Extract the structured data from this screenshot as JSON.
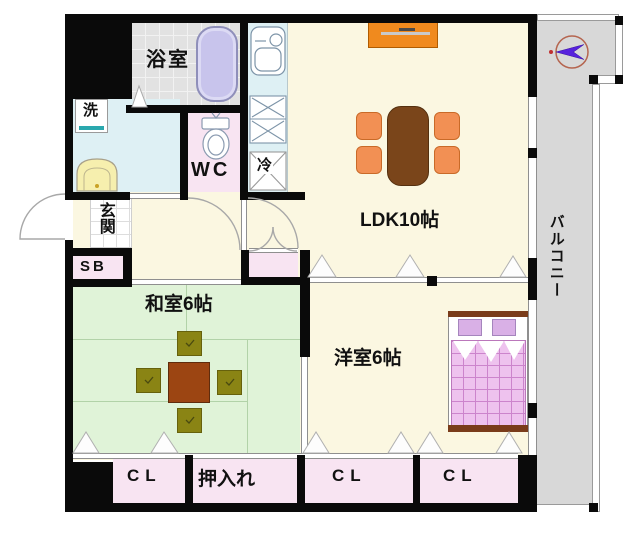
{
  "plan": {
    "rooms": {
      "bath": {
        "label": "浴室"
      },
      "washroom": {
        "washer_label": "洗"
      },
      "wc": {
        "label": "WC"
      },
      "kitchen": {
        "fridge_label": "冷"
      },
      "ldk": {
        "label": "LDK10帖"
      },
      "genkan": {
        "label": "玄関"
      },
      "shoe_box": {
        "label": "SB"
      },
      "washitsu": {
        "label": "和室6帖"
      },
      "yoshitsu": {
        "label": "洋室6帖"
      },
      "balcony": {
        "label": "バルコニー"
      },
      "closet_left": {
        "label": "CL"
      },
      "oshiire": {
        "label": "押入れ"
      },
      "closet_mid": {
        "label": "CL"
      },
      "closet_right": {
        "label": "CL"
      }
    },
    "icons": {
      "compass": "north-arrow-compass"
    },
    "colors": {
      "wall": "#0a0a0a",
      "ldk_floor": "#fbf7e1",
      "washitsu_floor": "#e0f3d8",
      "wet_area_floor": "#def0f4",
      "closet_floor": "#f8e4f2",
      "bath_floor": "#e2e2e2",
      "balcony_floor": "#d8d8d8",
      "bathtub": "#c8c4ec",
      "tv_board": "#f08a1e",
      "dining_table": "#7a451a",
      "chair": "#f29054",
      "low_table": "#9c4512",
      "zabuton": "#8a8414",
      "bed_blanket": "#eec2ee",
      "pillow": "#d9b0e6",
      "bed_frame": "#7a3c1a",
      "compass_arrow": "#5722dd",
      "compass_ring": "#b5654f"
    }
  }
}
